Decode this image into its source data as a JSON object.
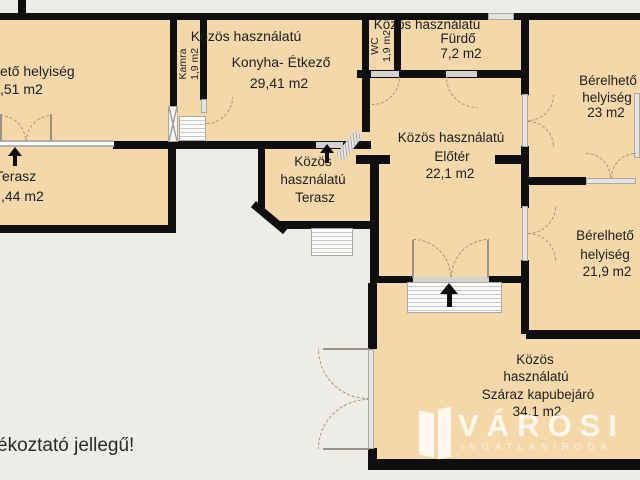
{
  "colors": {
    "floor": "#f4d8a9",
    "wall": "#0f0f0f",
    "background": "#eeece7",
    "door_gray": "#e6e4e0",
    "arc": "#a8906e",
    "watermark_white": "#ffffff"
  },
  "labels": {
    "room_top_left": {
      "l1": "ető helyiség",
      "l2": ",51 m2"
    },
    "kamra": {
      "l1": "Kamra",
      "l2": "1,9 m2"
    },
    "konyha": {
      "l1": "Közös használatú",
      "l2": "Konyha- Étkező",
      "l3": "29,41 m2"
    },
    "wc": {
      "l1": "WC",
      "l2": "1,9 m2"
    },
    "furdo": {
      "l1": "Közös használatú",
      "l2": "Fürdő",
      "l3": "7,2 m2"
    },
    "room_23": {
      "l1": "Bérelhető",
      "l2": "helyiség",
      "l3": "23 m2"
    },
    "eloter": {
      "l1": "Közös használatú",
      "l2": "Előtér",
      "l3": "22,1 m2"
    },
    "terasz_left": {
      "l1": "Terasz",
      "l2": ",44 m2"
    },
    "terasz_mid": {
      "l1": "Közös",
      "l2": "használatú",
      "l3": "Terasz"
    },
    "room_219": {
      "l1": "Bérelhető",
      "l2": "helyiség",
      "l3": "21,9 m2"
    },
    "kapubejaro": {
      "l1": "Közös",
      "l2": "használatú",
      "l3": "Száraz kapubejáró",
      "l4": "34,1 m2"
    },
    "footer_note": "ékoztató jellegű!",
    "watermark": {
      "title": "VÁROSI",
      "subtitle": "INGATLANIRODA"
    }
  }
}
